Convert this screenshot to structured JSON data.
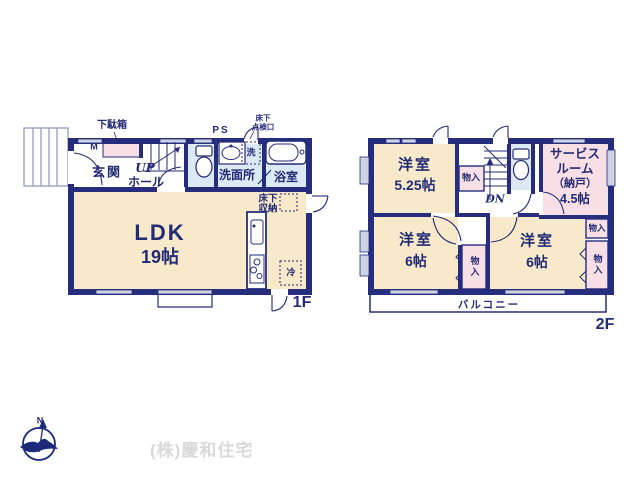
{
  "palette": {
    "wall": "#262d7c",
    "text": "#232b75",
    "room_cream": "#f7e9c9",
    "room_pink": "#f8dfe5",
    "room_blue": "#dce8f3",
    "window_gray": "#ccd3e3",
    "company_text": "#d9d9d9"
  },
  "floor1": {
    "floor_label": "1F",
    "entrance": "玄関",
    "shoe_cabinet": "下駄箱",
    "meter": "M",
    "stairs_up": "UP",
    "hall": "ホール",
    "pipe_space": "PS",
    "underfloor_hatch_line1": "床下",
    "underfloor_hatch_line2": "点検口",
    "washer": "洗",
    "washroom": "洗面所",
    "bathroom": "浴室",
    "ldk": "LDK",
    "ldk_size": "19帖",
    "underfloor_storage_line1": "床下",
    "underfloor_storage_line2": "収納",
    "fridge": "冷"
  },
  "floor2": {
    "floor_label": "2F",
    "bedroom1": "洋室",
    "bedroom1_size": "5.25帖",
    "closet1": "物入",
    "stairs_down": "DN",
    "service_room_line1": "サービス",
    "service_room_line2": "ルーム",
    "service_room_line3": "（納戸）",
    "service_room_line4": "4.5帖",
    "bedroom2": "洋室",
    "bedroom2_size": "6帖",
    "closet2": "物入",
    "bedroom3": "洋室",
    "bedroom3_size": "6帖",
    "closet3": "物入",
    "closet4": "物入",
    "balcony": "バルコニー"
  },
  "footer": {
    "company": "(株)慶和住宅",
    "compass_north": "N"
  }
}
